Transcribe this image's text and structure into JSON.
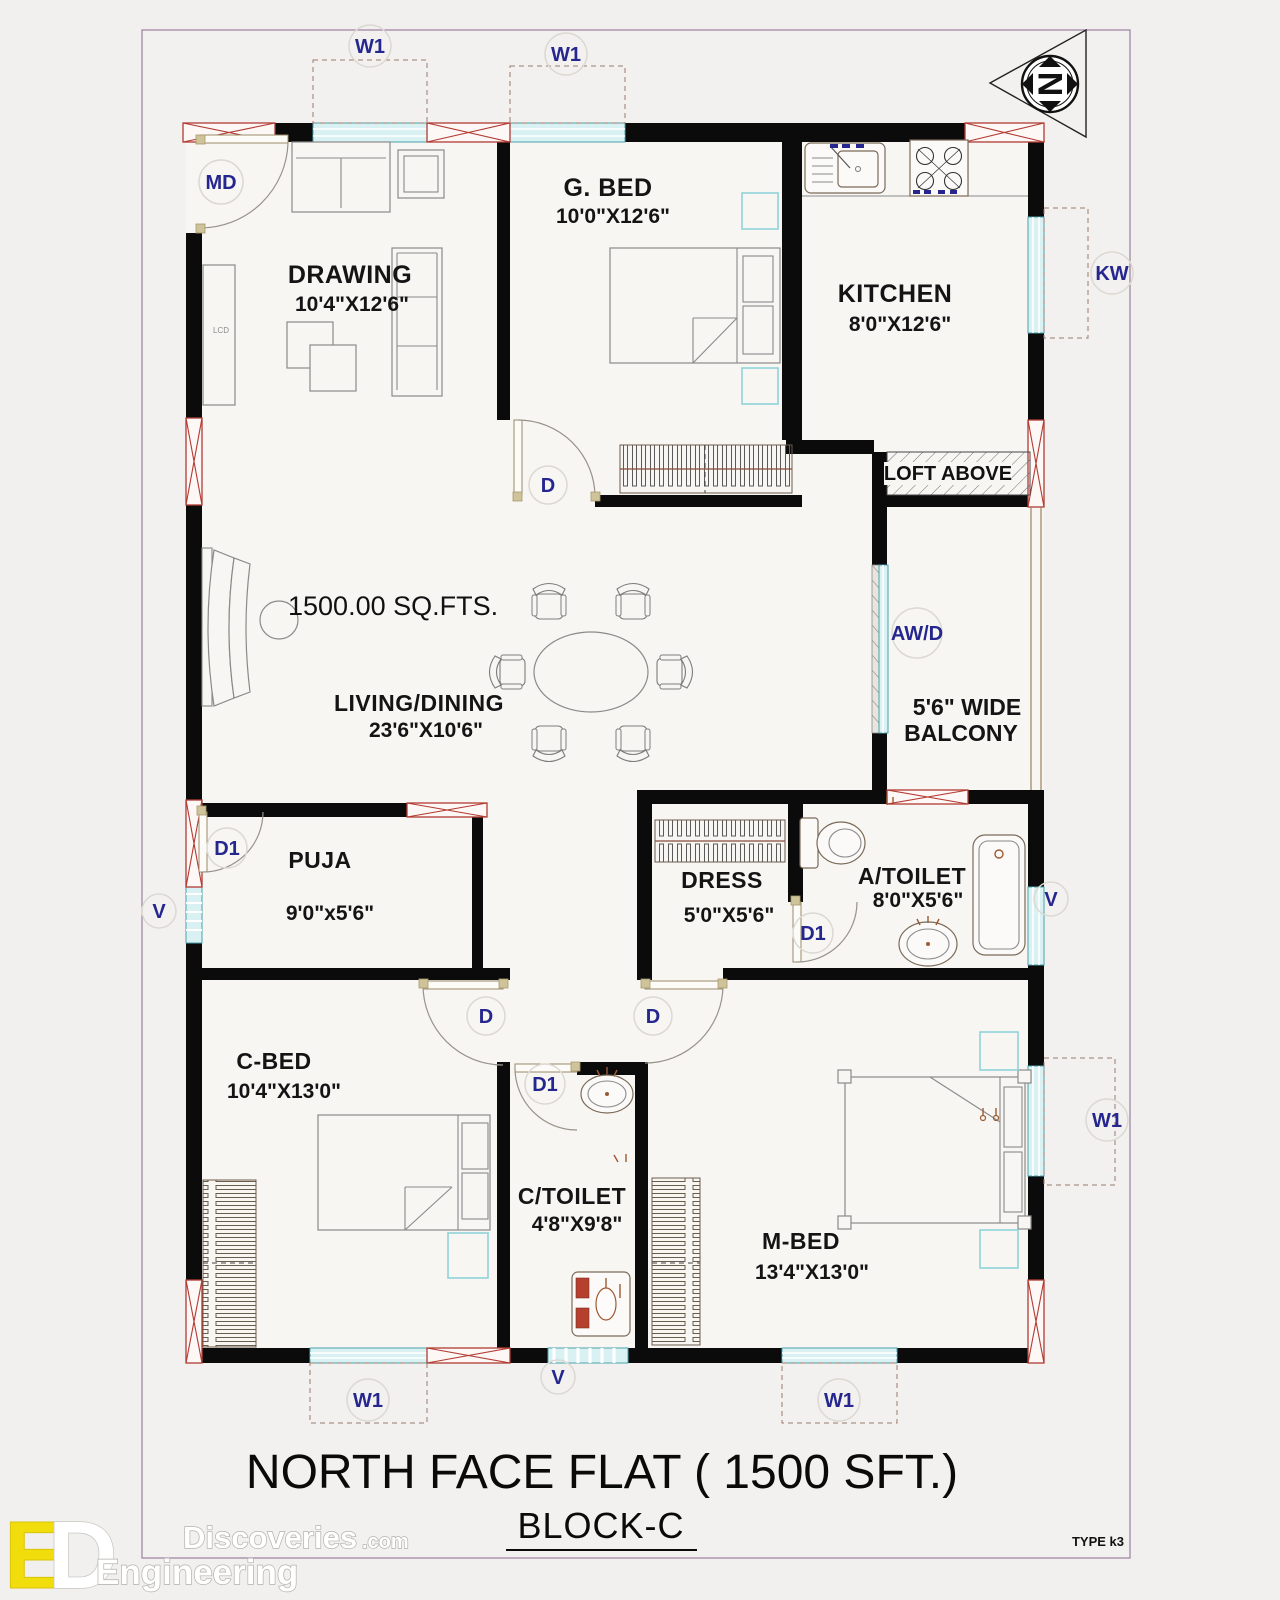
{
  "title": {
    "main": "NORTH FACE FLAT ( 1500 SFT.)",
    "block": "BLOCK-C",
    "type_code": "TYPE k3"
  },
  "plan": {
    "area_label": "1500.00 SQ.FTS.",
    "compass_letter": "N"
  },
  "rooms": {
    "drawing": {
      "name": "DRAWING",
      "size": "10'4\"X12'6\""
    },
    "guest_bed": {
      "name": "G. BED",
      "size": "10'0\"X12'6\""
    },
    "kitchen": {
      "name": "KITCHEN",
      "size": "8'0\"X12'6\""
    },
    "living_dining": {
      "name": "LIVING/DINING",
      "size": "23'6\"X10'6\""
    },
    "balcony": {
      "line1": "5'6\" WIDE",
      "line2": "BALCONY"
    },
    "loft": {
      "name": "LOFT ABOVE"
    },
    "puja": {
      "name": "PUJA",
      "size": "9'0\"x5'6\""
    },
    "dress": {
      "name": "DRESS",
      "size": "5'0\"X5'6\""
    },
    "attached_toilet": {
      "name": "A/TOILET",
      "size": "8'0\"X5'6\""
    },
    "child_bed": {
      "name": "C-BED",
      "size": "10'4\"X13'0\""
    },
    "common_toilet": {
      "name": "C/TOILET",
      "size": "4'8\"X9'8\""
    },
    "master_bed": {
      "name": "M-BED",
      "size": "13'4\"X13'0\""
    }
  },
  "markers": {
    "window": "W1",
    "main_door": "MD",
    "kitchen_window": "KW",
    "washer": "AW/D",
    "door": "D",
    "door_small": "D1",
    "ventilator": "V",
    "tv": "LCD"
  },
  "watermark": {
    "brand": "Discoveries",
    "brand_suffix": ".com",
    "brand_sub": "Engineering"
  },
  "colors": {
    "wall": "#0b0b0b",
    "window_fill": "#d9f1f3",
    "lintel_x": "#b23b32",
    "label_blue": "#26268f",
    "fixture_red": "#b5402e",
    "page_bg": "#f1f0ee",
    "logo_yellow": "#f2dd0c"
  }
}
